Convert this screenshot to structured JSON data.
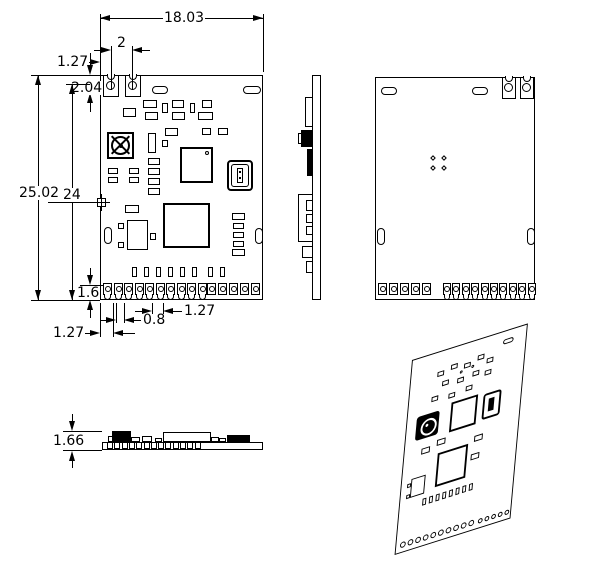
{
  "dimensions": {
    "board_width": "18.03",
    "hole_pitch": "2",
    "hole_offset": "1.27",
    "hole_depth": "2.04",
    "board_height": "25.02",
    "body_height": "24",
    "pin_pad_height": "1.6",
    "first_pin_offset": "1.27",
    "pin_pad_width": "0.8",
    "pin_pitch": "1.27",
    "module_thickness": "1.66"
  },
  "pins": {
    "front_castellated_count": 10,
    "front_pad_count": 5,
    "back_pad_count": 5,
    "back_castellated_count": 10,
    "top_pad_row_count": 8,
    "profile_pad_count": 13,
    "iso_castellated_count": 10,
    "iso_pad_count": 5
  },
  "colors": {
    "line": "#000000",
    "background": "#ffffff"
  }
}
